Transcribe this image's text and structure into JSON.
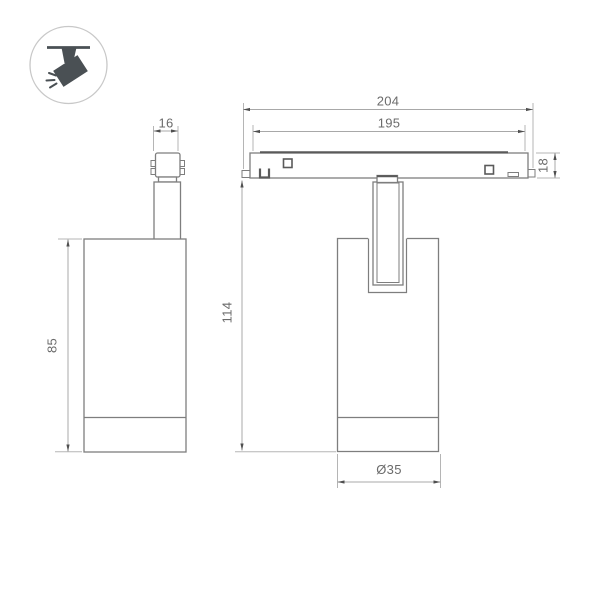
{
  "background": "#ffffff",
  "colors": {
    "background": "#ffffff",
    "outline": "#7e7e7e",
    "detail": "#5a5a5a",
    "dimline": "#a8a8a8",
    "extline": "#b5b5b5",
    "arrow": "#4f4f4f",
    "text": "#6b6b6b",
    "icon": "#4a5054",
    "icon_ring": "#c8c8c8"
  },
  "icon": {
    "name": "track-spotlight-icon"
  },
  "dims": {
    "adapter_width": "16",
    "body_height": "85",
    "track_length_overall": "204",
    "track_length_inner": "195",
    "track_height": "18",
    "overall_height": "114",
    "body_diameter": "Ø35"
  }
}
